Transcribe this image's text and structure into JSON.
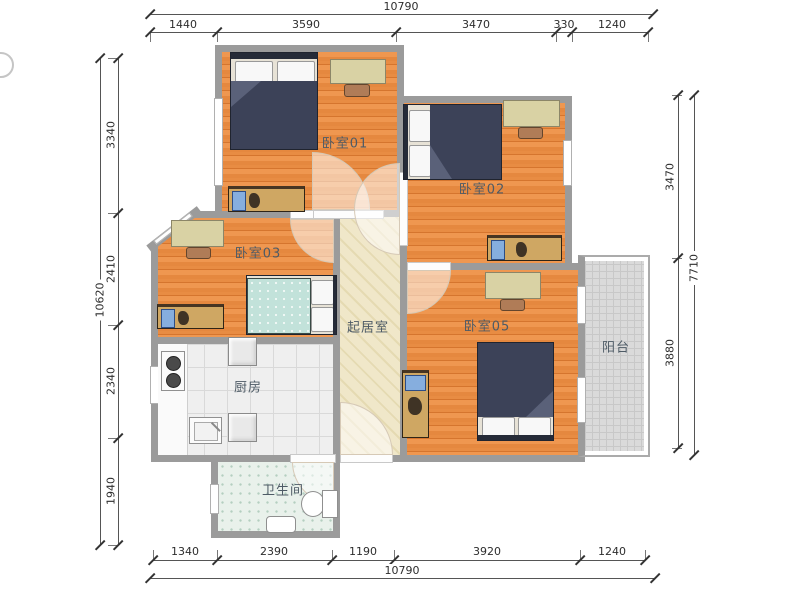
{
  "title": "apartment-floor-plan",
  "rooms": {
    "bedroom01": {
      "label": "卧室01"
    },
    "bedroom02": {
      "label": "卧室02"
    },
    "bedroom03": {
      "label": "卧室03"
    },
    "bedroom05": {
      "label": "卧室05"
    },
    "living_room": {
      "label": "起居室"
    },
    "kitchen": {
      "label": "厨房"
    },
    "bathroom": {
      "label": "卫生间"
    },
    "balcony": {
      "label": "阳台"
    }
  },
  "dimensions": {
    "top": {
      "total": "10790",
      "segments": [
        "1440",
        "3590",
        "3470",
        "330",
        "1240"
      ]
    },
    "bottom": {
      "total": "10790",
      "segments": [
        "1340",
        "2390",
        "1190",
        "3920",
        "1240"
      ]
    },
    "left": {
      "total": "10620",
      "segments": [
        "3340",
        "2410",
        "2340",
        "1940"
      ]
    },
    "right": {
      "total": "7710",
      "segments": [
        "3470",
        "3880"
      ]
    }
  },
  "colors": {
    "wall": "#9b9b9b",
    "wood_floor": "#e5883f",
    "living_floor": "#f0e7c9",
    "kitchen_floor": "#efefef",
    "bathroom_floor": "#e9f1eb",
    "balcony_floor": "#dadada",
    "bed_duvet_dark": "#3c4258",
    "bed_duvet_teal": "#c2e2da",
    "furniture_wood": "#cfa763",
    "dimension_line": "#555555",
    "label_text": "#4e5b66"
  }
}
